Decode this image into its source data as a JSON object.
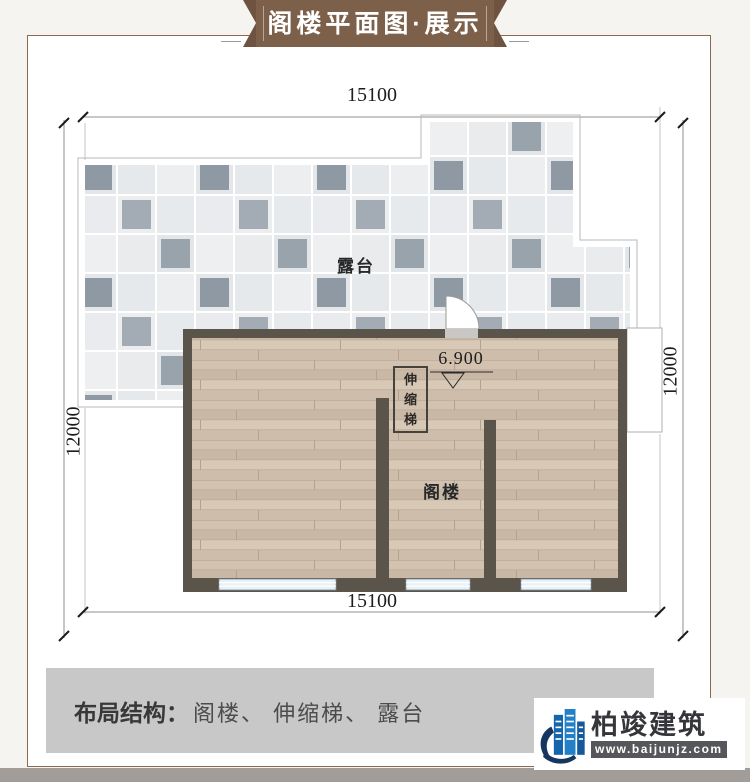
{
  "banner": {
    "title": "阁楼平面图·展示"
  },
  "plan": {
    "dimensions": {
      "top": "15100",
      "bottom": "15100",
      "left": "12000",
      "right": "12000"
    },
    "labels": {
      "terrace": "露台",
      "attic": "阁楼",
      "ladder": "伸缩梯",
      "elevation": "6.900"
    }
  },
  "footer": {
    "label": "布局结构：",
    "items_text": "阁楼、 伸缩梯、 露台"
  },
  "logo": {
    "brand": "柏竣建筑",
    "website": "www.baijunjz.com",
    "icon": "building-swoosh-icon"
  },
  "colors": {
    "ribbon_brown": "#7d6049",
    "frame_brown": "#8a6a50",
    "wall": "#5a544b",
    "tile_light": "#e9ebed",
    "tile_dark": "#98a2ab",
    "wood": "#cdbca9",
    "window_blue": "#e8f1f6",
    "footer_bar_gray": "#c8c8c8",
    "logo_blue": "#2480c6",
    "logo_navy": "#16355f"
  }
}
